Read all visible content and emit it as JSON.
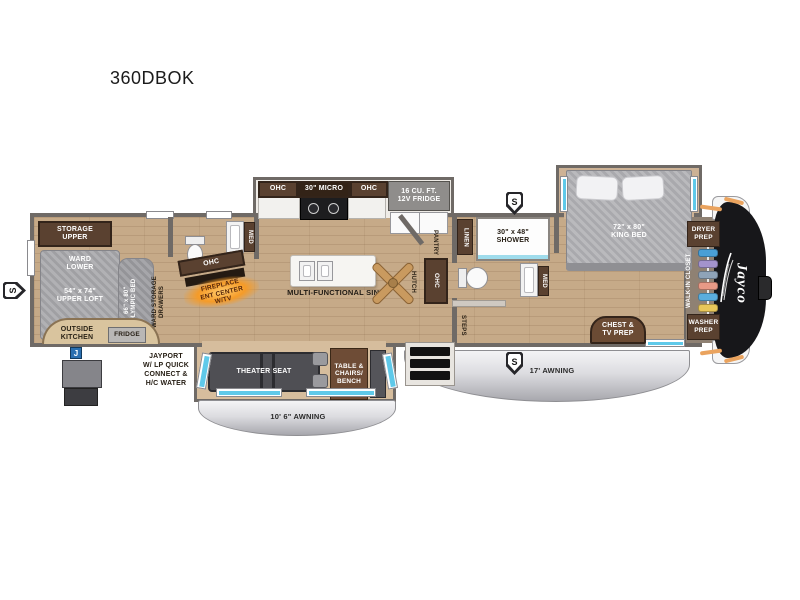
{
  "title": "360DBOK",
  "badges": {
    "s": "S",
    "j": "J"
  },
  "bunk_room": {
    "storage_upper": "STORAGE\nUPPER",
    "ward_lower": "WARD\nLOWER",
    "upper_loft": "54\" x 74\"\nUPPER LOFT",
    "olympic_bed": "66\" x 80\"\nOLYMPIC BED",
    "ward_storage": "WARD STORAGE\nDRAWERS",
    "outside_kitchen": "OUTSIDE\nKITCHEN",
    "fridge": "FRIDGE"
  },
  "exterior": {
    "jayport": "JAYPORT\nW/ LP QUICK\nCONNECT &\nH/C WATER",
    "awning_left": "10' 6\" AWNING",
    "awning_right": "17' AWNING",
    "brand": "Jayco"
  },
  "kitchen": {
    "ohc": "OHC",
    "micro": "30\" MICRO",
    "fridge": "16 CU. FT.\n12V FRIDGE",
    "island": "MULTI-FUNCTIONAL SINK",
    "pantry": "PANTRY",
    "hutch": "HUTCH"
  },
  "mid_bath": {
    "med": "MED"
  },
  "entertainment": {
    "ohc": "OHC",
    "fireplace": "FIREPLACE\nENT CENTER\nW/TV"
  },
  "main_bath": {
    "linen": "LINEN",
    "shower": "30\" x 48\"\nSHOWER",
    "med": "MED",
    "steps": "STEPS"
  },
  "bedroom": {
    "king_bed": "72\" x 80\"\nKING BED",
    "chest_tv": "CHEST &\nTV PREP",
    "dryer_prep": "DRYER\nPREP",
    "walk_in_closet": "WALK-IN CLOSET",
    "washer_prep": "WASHER\nPREP"
  },
  "living": {
    "theater_seat": "THEATER SEAT",
    "table_chairs": "TABLE &\nCHAIRS/\nBENCH"
  },
  "closet": {
    "clothes_colors": [
      "#4a9fd6",
      "#a393cc",
      "#8fa3b8",
      "#e89a86",
      "#5aaede",
      "#e8c75a"
    ]
  },
  "colors": {
    "wall": "#6f6a66",
    "floor_wood": "#c6aa88",
    "cabinet_brown": "#5a4130",
    "window_blue": "#5fc9e9",
    "accent_orange": "#eaa35e",
    "awning_silver": "#dcdce0",
    "brand_black": "#17171a"
  }
}
